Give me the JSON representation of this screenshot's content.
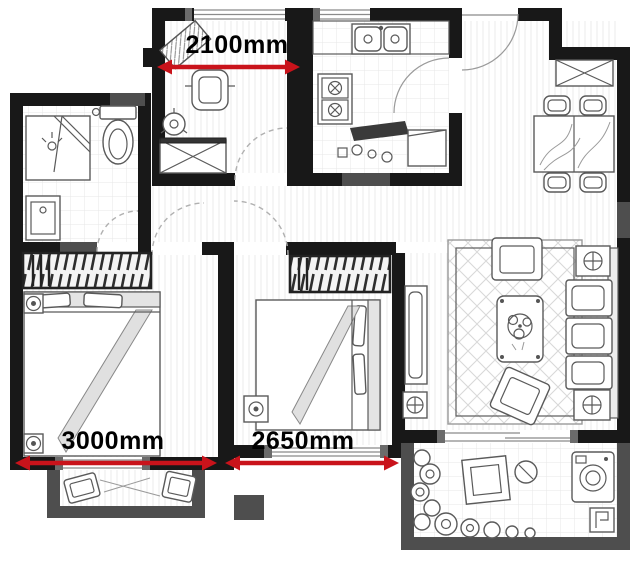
{
  "plan": {
    "dimensions": [
      {
        "id": "study-width",
        "label": "2100mm"
      },
      {
        "id": "left-bedroom-width",
        "label": "3000mm"
      },
      {
        "id": "middle-bedroom-width",
        "label": "2650mm"
      }
    ],
    "colors": {
      "wall": "#181818",
      "wall_secondary": "#4e4e4e",
      "dimension_accent": "#c9131b",
      "sketch": "#5a5a5a"
    }
  }
}
